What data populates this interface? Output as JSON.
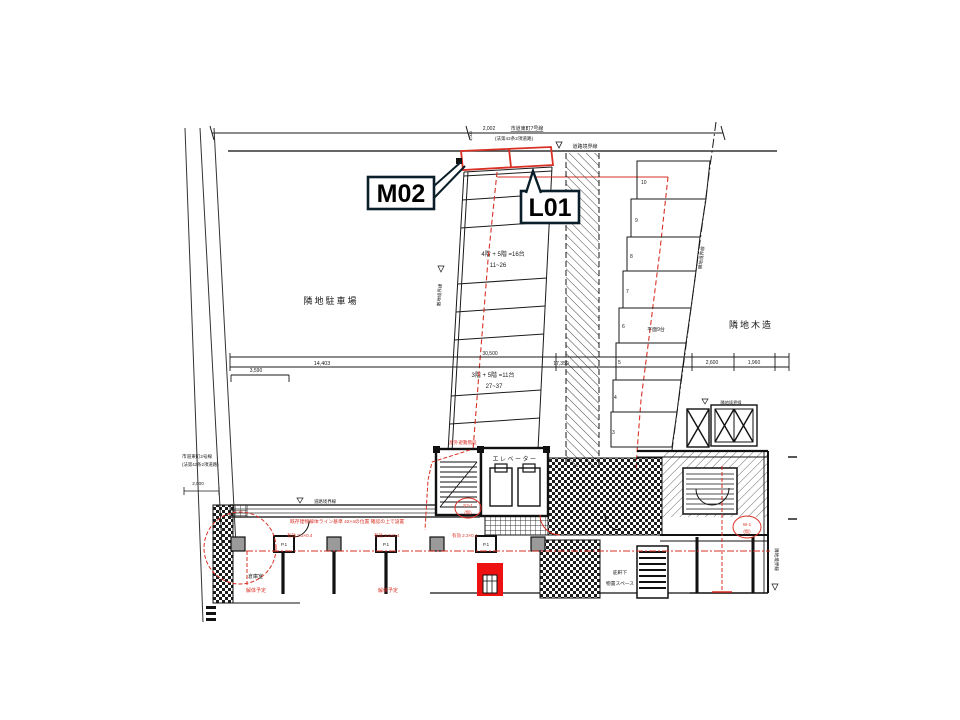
{
  "annotations": {
    "m02": "M02",
    "l01": "L01"
  },
  "areas": {
    "left": "隣地駐車場",
    "right": "隣地木造"
  },
  "roads": {
    "top_dim": "2,002",
    "top_name": "市道東町7号線",
    "top_sub": "(法第42条2項道路)",
    "width_dim": "4,000",
    "left_name": "市道東町2号線",
    "left_sub": "(法第42条2項道路)"
  },
  "boundaries": {
    "road": "道路境界線",
    "site": "敷地境界線",
    "neighbor": "隣地境界線"
  },
  "parking": {
    "note_a1": "4階 + 5階 =16台",
    "note_a2": "11~26",
    "note_b1": "3階 + 5階 =11台",
    "note_b2": "27~37",
    "flat": "平面9台",
    "numbers": [
      "10",
      "9",
      "8",
      "7",
      "6",
      "5",
      "4",
      "3"
    ]
  },
  "dims": {
    "a": "14,403",
    "b": "3,590",
    "c": "30,500",
    "d": "17,350",
    "e": "2,600",
    "f": "1,960",
    "g": "2,000"
  },
  "plan": {
    "elevator": "エレベーター",
    "eaves1": "庇軒下",
    "eaves2": "物置スペース",
    "storage": "倉庫室",
    "column": "P.1",
    "stair_note": "屋外避難階段",
    "red_note": "既存建物解体ライン基準 42×4の位置 確認の上で設置",
    "red_dim": "有効 2.3×0.4",
    "w1": "W-1",
    "w2": "S2-1",
    "kari": "(仮)",
    "demolish": "解体予定"
  },
  "colors": {
    "line": "#1a1a1a",
    "red": "#d93025",
    "red_fill": "#ee1111",
    "gray": "#9a9a9a"
  }
}
